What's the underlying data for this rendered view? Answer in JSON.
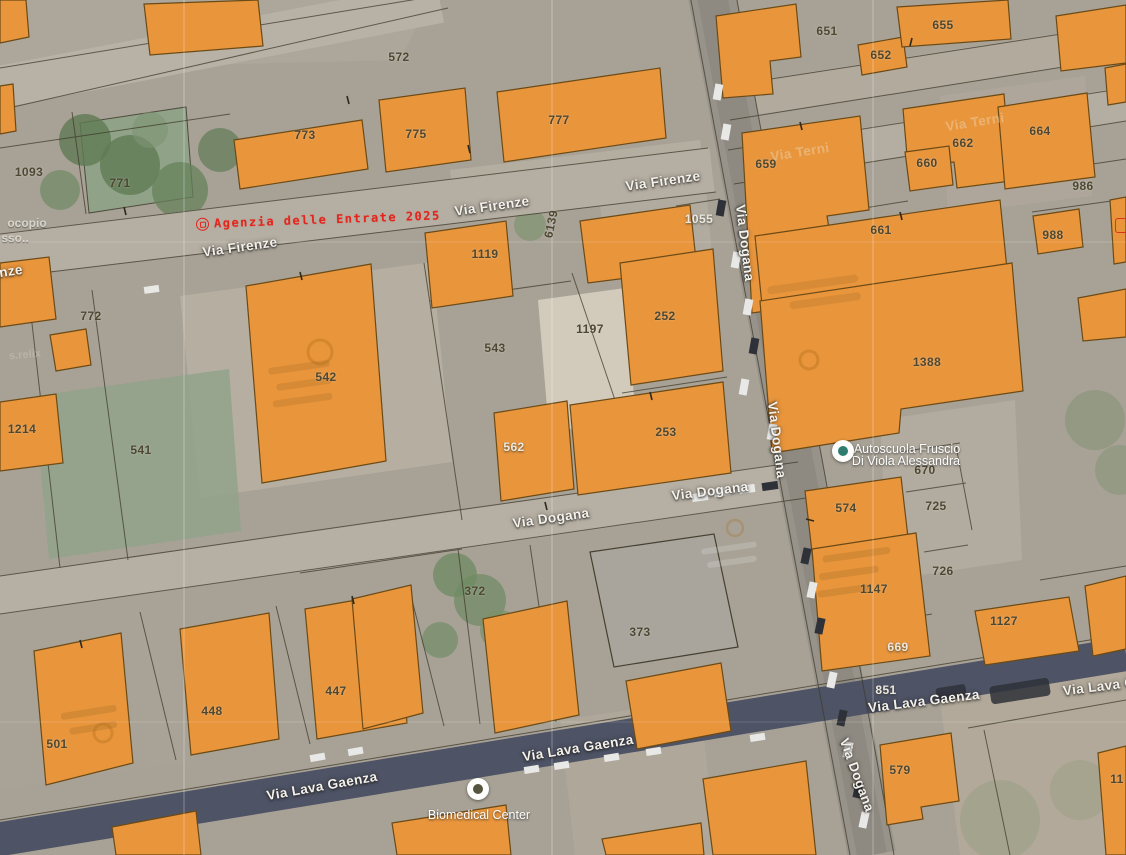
{
  "map": {
    "watermark": {
      "text": "Agenzia delle Entrate 2025",
      "color": "#e3261d"
    },
    "colors": {
      "building_fill": "#E8953C",
      "building_stroke": "#6b4a16",
      "road_light": "#b5aea2",
      "road_dark_asphalt": "#4e5365",
      "parcel_label_dark": "#4e4832",
      "parcel_label_light": "#ece9e0",
      "watermark_red": "#e3261d",
      "vegetation_green": "#8ca487"
    },
    "parcel_labels": [
      {
        "text": "572",
        "x": 399,
        "y": 57
      },
      {
        "text": "1093",
        "x": 29,
        "y": 172
      },
      {
        "text": "771",
        "x": 120,
        "y": 183
      },
      {
        "text": "773",
        "x": 305,
        "y": 135
      },
      {
        "text": "775",
        "x": 416,
        "y": 134
      },
      {
        "text": "777",
        "x": 559,
        "y": 120
      },
      {
        "text": "651",
        "x": 827,
        "y": 31
      },
      {
        "text": "652",
        "x": 881,
        "y": 55
      },
      {
        "text": "655",
        "x": 943,
        "y": 25
      },
      {
        "text": "659",
        "x": 766,
        "y": 164
      },
      {
        "text": "660",
        "x": 927,
        "y": 163
      },
      {
        "text": "661",
        "x": 881,
        "y": 230
      },
      {
        "text": "662",
        "x": 963,
        "y": 143
      },
      {
        "text": "664",
        "x": 1040,
        "y": 131
      },
      {
        "text": "986",
        "x": 1083,
        "y": 186
      },
      {
        "text": "988",
        "x": 1053,
        "y": 235
      },
      {
        "text": "1055",
        "x": 699,
        "y": 219,
        "tone": "light"
      },
      {
        "text": "1119",
        "x": 485,
        "y": 254
      },
      {
        "text": "6139",
        "x": 551,
        "y": 224,
        "rotation": -78
      },
      {
        "text": "543",
        "x": 495,
        "y": 348
      },
      {
        "text": "1197",
        "x": 590,
        "y": 329
      },
      {
        "text": "252",
        "x": 665,
        "y": 316
      },
      {
        "text": "772",
        "x": 91,
        "y": 316
      },
      {
        "text": "542",
        "x": 326,
        "y": 377
      },
      {
        "text": "541",
        "x": 141,
        "y": 450
      },
      {
        "text": "1214",
        "x": 22,
        "y": 429
      },
      {
        "text": "562",
        "x": 514,
        "y": 447,
        "tone": "light"
      },
      {
        "text": "253",
        "x": 666,
        "y": 432
      },
      {
        "text": "1388",
        "x": 927,
        "y": 362
      },
      {
        "text": "670",
        "x": 925,
        "y": 470
      },
      {
        "text": "574",
        "x": 846,
        "y": 508
      },
      {
        "text": "725",
        "x": 936,
        "y": 506
      },
      {
        "text": "726",
        "x": 943,
        "y": 571
      },
      {
        "text": "1147",
        "x": 874,
        "y": 589
      },
      {
        "text": "1127",
        "x": 1004,
        "y": 621
      },
      {
        "text": "669",
        "x": 898,
        "y": 647,
        "tone": "light"
      },
      {
        "text": "851",
        "x": 886,
        "y": 690,
        "tone": "light"
      },
      {
        "text": "372",
        "x": 475,
        "y": 591
      },
      {
        "text": "373",
        "x": 640,
        "y": 632
      },
      {
        "text": "447",
        "x": 336,
        "y": 691
      },
      {
        "text": "448",
        "x": 212,
        "y": 711
      },
      {
        "text": "501",
        "x": 57,
        "y": 744
      },
      {
        "text": "579",
        "x": 900,
        "y": 770
      },
      {
        "text": "11",
        "x": 1117,
        "y": 779
      }
    ],
    "street_labels": [
      {
        "text": "Via Firenze",
        "x": 240,
        "y": 247,
        "rotation": -8
      },
      {
        "text": "Via Firenze",
        "x": 492,
        "y": 206,
        "rotation": -8
      },
      {
        "text": "Via Firenze",
        "x": 663,
        "y": 181,
        "rotation": -8
      },
      {
        "text": "Via Dogana",
        "x": 551,
        "y": 518,
        "rotation": -8
      },
      {
        "text": "Via Dogana",
        "x": 710,
        "y": 491,
        "rotation": -7
      },
      {
        "text": "Via Dogana",
        "x": 745,
        "y": 243,
        "rotation": 83
      },
      {
        "text": "Via Dogana",
        "x": 777,
        "y": 440,
        "rotation": 83
      },
      {
        "text": "Via Dogana",
        "x": 857,
        "y": 775,
        "rotation": 70
      },
      {
        "text": "Via Lava Gaenza",
        "x": 322,
        "y": 786,
        "rotation": -10
      },
      {
        "text": "Via Lava Gaenza",
        "x": 578,
        "y": 748,
        "rotation": -9
      },
      {
        "text": "Via Lava Gaenza",
        "x": 924,
        "y": 701,
        "rotation": -7
      },
      {
        "text": "Via Lava Ga",
        "x": 1103,
        "y": 686,
        "rotation": -7
      },
      {
        "text": "nze",
        "x": 11,
        "y": 271,
        "rotation": -8
      },
      {
        "text": "Via Terni",
        "x": 975,
        "y": 122,
        "rotation": -9,
        "ghost": true
      },
      {
        "text": "Via Terni",
        "x": 800,
        "y": 152,
        "rotation": -9,
        "ghost": true
      }
    ],
    "poi_labels": [
      {
        "text": "Autoscuola Fruscio",
        "x": 907,
        "y": 449,
        "kind": "poi-white"
      },
      {
        "text": "Di Viola Alessandra",
        "x": 906,
        "y": 461,
        "kind": "poi-white"
      },
      {
        "text": "Biomedical Center",
        "x": 479,
        "y": 815,
        "kind": "poi-white"
      },
      {
        "text": "ocopio",
        "x": 27,
        "y": 223,
        "kind": "poi-grey"
      },
      {
        "text": "sso..",
        "x": 15,
        "y": 238,
        "kind": "poi-grey"
      },
      {
        "text": "s.relix",
        "x": 25,
        "y": 355,
        "kind": "poi-ghost",
        "rotation": -5
      }
    ],
    "poi_pins": [
      {
        "icon": "driving-school-pin-icon",
        "x": 843,
        "y": 451,
        "core": "#2e7d6e"
      },
      {
        "icon": "biomedical-pin-icon",
        "x": 478,
        "y": 789,
        "core": "#56533f"
      }
    ]
  }
}
